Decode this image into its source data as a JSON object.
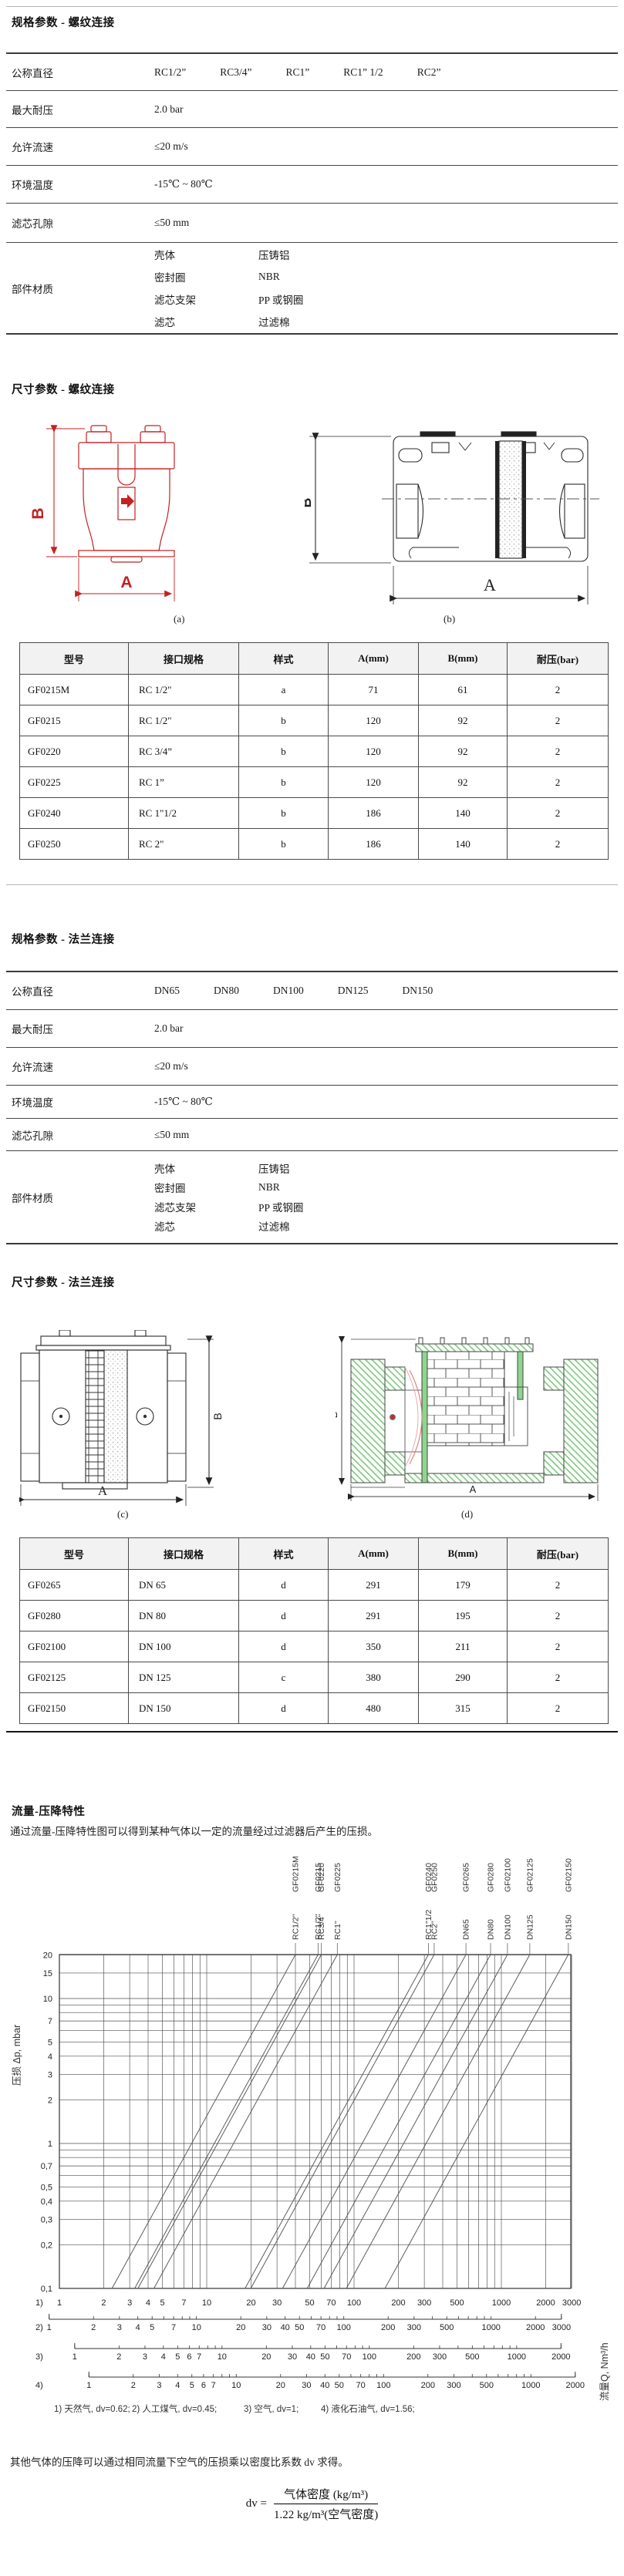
{
  "headings": {
    "spec_threaded": "规格参数 - 螺纹连接",
    "dim_threaded": "尺寸参数 - 螺纹连接",
    "spec_flanged": "规格参数 - 法兰连接",
    "dim_flanged": "尺寸参数 - 法兰连接",
    "flow": "流量-压降特性"
  },
  "figures": {
    "a": "(a)",
    "b": "(b)",
    "c": "(c)",
    "d": "(d)"
  },
  "dims": {
    "width": "A",
    "height": "B"
  },
  "spec_threaded": {
    "labels": {
      "diameter": "公称直径",
      "pressure": "最大耐压",
      "velocity": "允许流速",
      "temperature": "环境温度",
      "pore": "滤芯孔隙",
      "materials": "部件材质"
    },
    "values": {
      "diameters": [
        "RC1/2”",
        "RC3/4”",
        "RC1”",
        "RC1” 1/2",
        "RC2”"
      ],
      "pressure": "2.0 bar",
      "velocity": "≤20 m/s",
      "temperature": "-15℃ ~ 80℃",
      "pore": "≤50 mm"
    },
    "materials": [
      {
        "part": "壳体",
        "material": "压铸铝"
      },
      {
        "part": "密封圈",
        "material": "NBR"
      },
      {
        "part": "滤芯支架",
        "material": "PP 或钢圈"
      },
      {
        "part": "滤芯",
        "material": "过滤棉"
      }
    ]
  },
  "spec_flanged": {
    "labels": {
      "diameter": "公称直径",
      "pressure": "最大耐压",
      "velocity": "允许流速",
      "temperature": "环境温度",
      "pore": "滤芯孔隙",
      "materials": "部件材质"
    },
    "values": {
      "diameters": [
        "DN65",
        "DN80",
        "DN100",
        "DN125",
        "DN150"
      ],
      "pressure": "2.0 bar",
      "velocity": "≤20 m/s",
      "temperature": "-15℃ ~ 80℃",
      "pore": "≤50 mm"
    },
    "materials": [
      {
        "part": "壳体",
        "material": "压铸铝"
      },
      {
        "part": "密封圈",
        "material": "NBR"
      },
      {
        "part": "滤芯支架",
        "material": "PP 或钢圈"
      },
      {
        "part": "滤芯",
        "material": "过滤棉"
      }
    ]
  },
  "dim_threaded_table": {
    "headers": [
      "型号",
      "接口规格",
      "样式",
      "A(mm)",
      "B(mm)",
      "耐压(bar)"
    ],
    "rows": [
      [
        "GF0215M",
        "RC 1/2\"",
        "a",
        "71",
        "61",
        "2"
      ],
      [
        "GF0215",
        "RC 1/2\"",
        "b",
        "120",
        "92",
        "2"
      ],
      [
        "GF0220",
        "RC 3/4”",
        "b",
        "120",
        "92",
        "2"
      ],
      [
        "GF0225",
        "RC 1”",
        "b",
        "120",
        "92",
        "2"
      ],
      [
        "GF0240",
        "RC 1\"1/2",
        "b",
        "186",
        "140",
        "2"
      ],
      [
        "GF0250",
        "RC 2\"",
        "b",
        "186",
        "140",
        "2"
      ]
    ]
  },
  "dim_flanged_table": {
    "headers": [
      "型号",
      "接口规格",
      "样式",
      "A(mm)",
      "B(mm)",
      "耐压(bar)"
    ],
    "rows": [
      [
        "GF0265",
        "DN 65",
        "d",
        "291",
        "179",
        "2"
      ],
      [
        "GF0280",
        "DN 80",
        "d",
        "291",
        "195",
        "2"
      ],
      [
        "GF02100",
        "DN 100",
        "d",
        "350",
        "211",
        "2"
      ],
      [
        "GF02125",
        "DN 125",
        "c",
        "380",
        "290",
        "2"
      ],
      [
        "GF02150",
        "DN 150",
        "d",
        "480",
        "315",
        "2"
      ]
    ]
  },
  "flow_section": {
    "intro": "通过流量-压降特性图可以得到某种气体以一定的流量经过过滤器后产生的压损。",
    "note": "其他气体的压降可以通过相同流量下空气的压损乘以密度比系数 dv 求得。",
    "formula": {
      "lhs": "dv =",
      "numerator": "气体密度 (kg/m³)",
      "denominator": "1.22 kg/m³(空气密度)"
    }
  },
  "chart_data": {
    "type": "line",
    "title": "流量-压降特性",
    "ylabel": "压损 Δp, mbar",
    "xlabel": "流量Q, Nm³/h",
    "grid": true,
    "y_axis": {
      "scale": "log",
      "min": 0.1,
      "max": 20,
      "tick_values": [
        20,
        15,
        10,
        7,
        5,
        4,
        3,
        2,
        1,
        0.7,
        0.5,
        0.4,
        0.3,
        0.2,
        0.1
      ],
      "tick_labels": [
        "20",
        "15",
        "10",
        "7",
        "5",
        "4",
        "3",
        "2",
        "1",
        "0,7",
        "0,5",
        "0,4",
        "0,3",
        "0,2",
        "0,1"
      ]
    },
    "x_axis": {
      "scale": "log",
      "min": 1,
      "max": 3000,
      "reference_scale": "天然气"
    },
    "x_scales": [
      {
        "id": "1)",
        "gas": "天然气",
        "dv": 0.62,
        "footnote": "天然气, dv=0.62;",
        "max": 3000,
        "labeled_ticks": [
          1,
          2,
          3,
          4,
          5,
          7,
          10,
          20,
          30,
          50,
          70,
          100,
          200,
          300,
          500,
          1000,
          2000,
          3000
        ]
      },
      {
        "id": "2)",
        "gas": "人工煤气",
        "dv": 0.45,
        "footnote": "人工煤气, dv=0.45;",
        "max": 3000,
        "labeled_ticks": [
          1,
          2,
          3,
          4,
          5,
          7,
          10,
          20,
          30,
          40,
          50,
          70,
          100,
          200,
          300,
          500,
          1000,
          2000,
          3000
        ]
      },
      {
        "id": "3)",
        "gas": "空气",
        "dv": 1,
        "footnote": "空气, dv=1;",
        "max": 2000,
        "labeled_ticks": [
          1,
          2,
          3,
          4,
          5,
          6,
          7,
          10,
          20,
          30,
          40,
          50,
          70,
          100,
          200,
          300,
          500,
          1000,
          2000
        ]
      },
      {
        "id": "4)",
        "gas": "液化石油气",
        "dv": 1.56,
        "footnote": "液化石油气, dv=1.56;",
        "max": 2000,
        "labeled_ticks": [
          1,
          2,
          3,
          4,
          5,
          6,
          7,
          10,
          20,
          30,
          40,
          50,
          70,
          100,
          200,
          300,
          500,
          1000,
          2000
        ]
      }
    ],
    "pressure_exponent": 1.85,
    "series": [
      {
        "model": "GF0215M",
        "size": "RC1/2\"",
        "q_at_20mbar_scale1": 40
      },
      {
        "model": "GF0215",
        "size": "RC1/2\"",
        "q_at_20mbar_scale1": 57
      },
      {
        "model": "GF0220",
        "size": "RC3/4\"",
        "q_at_20mbar_scale1": 60
      },
      {
        "model": "GF0225",
        "size": "RC1\"",
        "q_at_20mbar_scale1": 77
      },
      {
        "model": "GF0240",
        "size": "RC1\"1/2",
        "q_at_20mbar_scale1": 320
      },
      {
        "model": "GF0250",
        "size": "RC2\"",
        "q_at_20mbar_scale1": 350
      },
      {
        "model": "GF0265",
        "size": "DN65",
        "q_at_20mbar_scale1": 575
      },
      {
        "model": "GF0280",
        "size": "DN80",
        "q_at_20mbar_scale1": 845
      },
      {
        "model": "GF02100",
        "size": "DN100",
        "q_at_20mbar_scale1": 1100
      },
      {
        "model": "GF02125",
        "size": "DN125",
        "q_at_20mbar_scale1": 1560
      },
      {
        "model": "GF02150",
        "size": "DN150",
        "q_at_20mbar_scale1": 2850
      }
    ]
  }
}
